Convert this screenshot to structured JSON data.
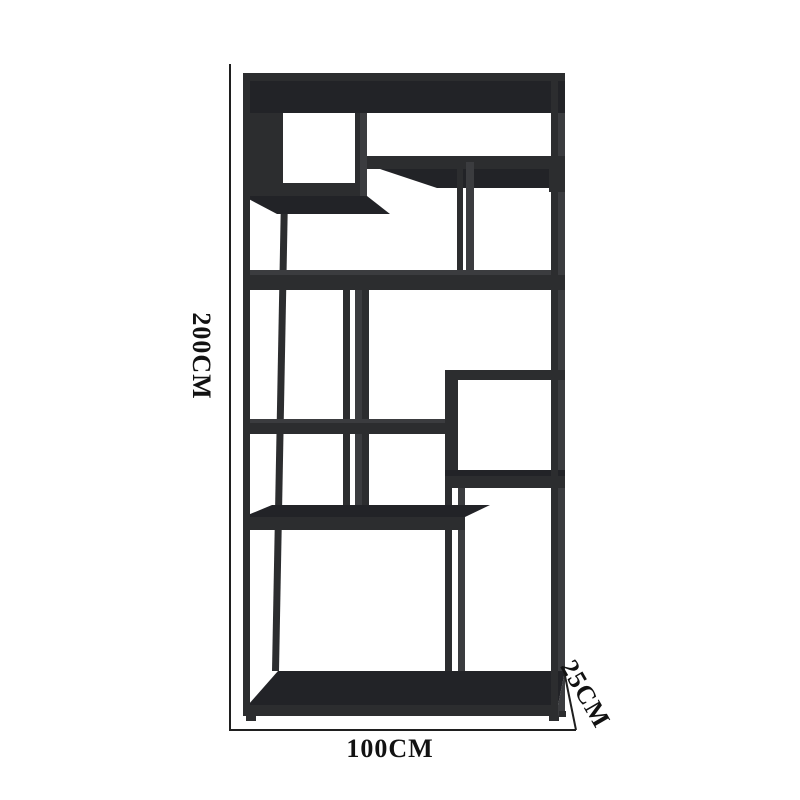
{
  "page": {
    "description": "Dimension diagram of a black metal etagere bookshelf",
    "background": "#ffffff"
  },
  "labels": {
    "height": "200CM",
    "width": "100CM",
    "depth": "25CM"
  },
  "colors": {
    "bg": "#ffffff",
    "face": "#2c2d2f",
    "deep": "#222327",
    "side": "#3b3c3f",
    "line": "#1f1f1f",
    "text": "#121212"
  }
}
